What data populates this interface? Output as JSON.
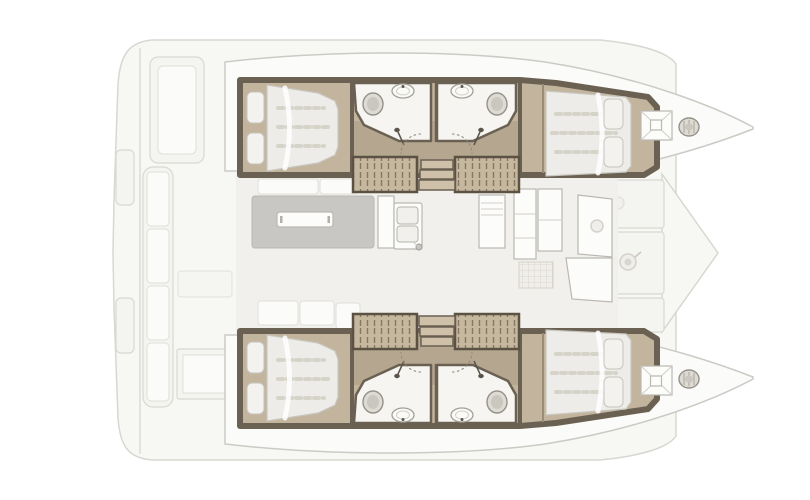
{
  "figure": {
    "type": "boat-floor-plan",
    "subject": "Catamaran interior layout plan, top view, bow pointing right",
    "visible_text": "",
    "features": {
      "hulls": 2,
      "double_bed_cabins": 4,
      "pillows_per_bed": 2,
      "bathrooms": 4,
      "toilets": 4,
      "washbasins": 4,
      "shower_heads": 4,
      "companionway_stairs": 2,
      "slatted_steps": 4,
      "saloon_tables": 1,
      "galley_sink_basins": 2,
      "bow_deck_hatches": 2,
      "windlasses": 2,
      "aft_cockpit_bench_cushions": 4,
      "forward_lounge_panels": 3
    }
  },
  "palette": {
    "bg": "#ffffff",
    "deck": "#f7f7f4",
    "deckline": "#d8d7d1",
    "hull": "#fbfbf9",
    "hullline": "#cbcbc5",
    "panel": "#f4f4f0",
    "panelline": "#d9d8d2",
    "wall": "#6b6153",
    "tan": "#c3b49d",
    "tandark": "#b5a68f",
    "slat": "#c6b79f",
    "slatline": "#857760",
    "step": "#cfc1a9",
    "white": "#f6f5f2",
    "mattress": "#edece8",
    "mattline": "#c8c6be",
    "stripe": "#d6d3c9",
    "pillow": "#f3f2ef",
    "fixture": "#dedbd4",
    "fixline": "#95928a",
    "table": "#c9c7c3",
    "tabletop": "#fcfcfa",
    "icon": "#5a544b",
    "floor": "#f1f0ec"
  }
}
